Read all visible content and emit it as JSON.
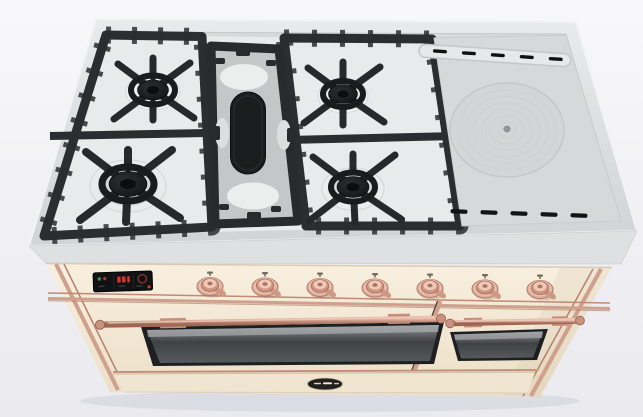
{
  "meta": {
    "description": "3D product render of a freestanding dual-fuel range cooker in antique white with copper trim, viewed from the front at a high angle"
  },
  "palette": {
    "background": "#f2f2f6",
    "cooktop_steel": "#d8d9db",
    "cooktop_rim": "#eceded",
    "grate_iron": "#2a2c2f",
    "burner_cap": "#141517",
    "enamel": "#e9eaeb",
    "body_cream": "#f3e9d6",
    "trim_copper": "#c9927f",
    "knob_copper": "#dcab9b",
    "oven_glass": "#44474a",
    "display_background": "#121315",
    "display_red": "#d8362a",
    "display_green": "#3f8f4f",
    "badge_black": "#231f1d"
  },
  "cooktop": {
    "grate_section": {
      "burners": [
        {
          "id": "back-left",
          "type": "gas-burner",
          "size": "medium"
        },
        {
          "id": "back-right",
          "type": "gas-burner",
          "size": "medium"
        },
        {
          "id": "front-left",
          "type": "gas-burner",
          "size": "large"
        },
        {
          "id": "front-right",
          "type": "gas-burner",
          "size": "medium"
        }
      ],
      "center_plate": {
        "id": "center-oval-griddle",
        "type": "oval-cast-iron-plate"
      }
    },
    "flat_section": {
      "french_top": {
        "type": "round-simmer-plate"
      },
      "back_vent_slots": 5,
      "front_vent_slots": 5
    }
  },
  "front_panel": {
    "display": {
      "type": "digital-oven-display",
      "zones": 3,
      "value_legible": false
    },
    "knobs": {
      "count": 7,
      "finish": "copper",
      "style": "lever-handle"
    }
  },
  "ovens": {
    "left_door": {
      "window": true,
      "handle": "copper-rail"
    },
    "right_door": {
      "window": true,
      "handle": "copper-rail"
    }
  },
  "kickplate": {
    "brand_badge": {
      "shape": "oval",
      "text_legible": false
    }
  }
}
